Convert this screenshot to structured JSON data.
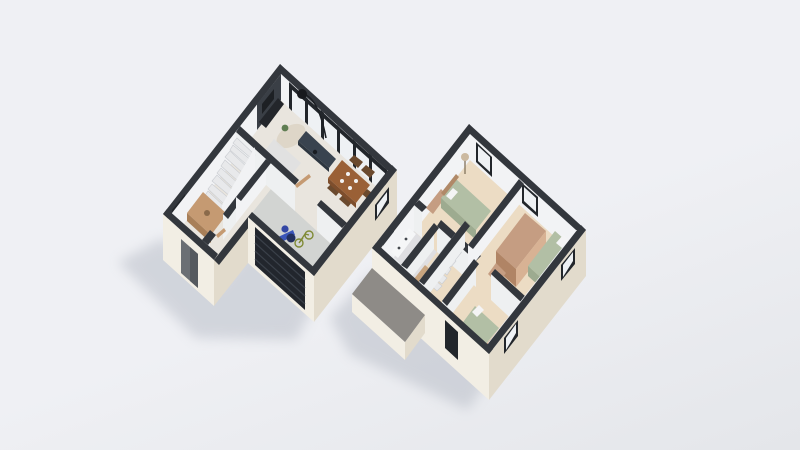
{
  "scene": {
    "type": "3d-floor-plan-render",
    "floors": [
      {
        "id": "ground-floor",
        "rooms": [
          "living-dining-kitchen",
          "hallway",
          "staircase",
          "garage",
          "entry-porch"
        ],
        "furniture": [
          "tv-media-wall",
          "sofa",
          "round-rug",
          "kitchen-island",
          "arc-floor-lamp",
          "dining-table",
          "dining-chairs",
          "under-stair-desk",
          "motorcycle",
          "bicycle"
        ]
      },
      {
        "id": "upper-floor",
        "rooms": [
          "bedroom-1",
          "bedroom-2",
          "bedroom-3",
          "bathroom",
          "landing-corridor",
          "stairwell"
        ],
        "furniture": [
          "double-bed",
          "single-bed",
          "wardrobe",
          "desk",
          "dresser",
          "vanity",
          "washer",
          "toilet",
          "linen-shelf",
          "floor-lamp",
          "plant"
        ],
        "exterior": [
          "flat-roof-over-porch"
        ]
      }
    ]
  },
  "colors": {
    "background": "#eff0f4",
    "background_edge": "#e4e6ea",
    "wall_cap": "#33373d",
    "wall_cream": "#f2eee4",
    "wall_cream_lit": "#f5f1e8",
    "wall_cream_shade": "#e2dbcc",
    "wall_white": "#f2f3f5",
    "wall_white_shade": "#eef0f1",
    "floor_main": "#e9e5de",
    "floor_wood": "#ecdcc4",
    "floor_concrete": "#d2d4d2",
    "floor_bath": "#dfdfe2",
    "accent_navy": "#39434f",
    "garage_door": "#22262d",
    "glass": "#eef1f4",
    "frame_dark": "#22262b",
    "wood_mid": "#c59a72",
    "wood_dark": "#9a6036",
    "chair_wood": "#6b4a2e",
    "bed_green": "#b2bfa5",
    "wood_pink": "#c59d82",
    "wood_pink_dark": "#b08465",
    "roof_gray": "#8e8b87",
    "plant_green": "#5f7d52",
    "bike_blue": "#3b55b8",
    "bike_green": "#97a23c",
    "door_gray": "#6b6f74",
    "shadow": "#aab0bc"
  }
}
